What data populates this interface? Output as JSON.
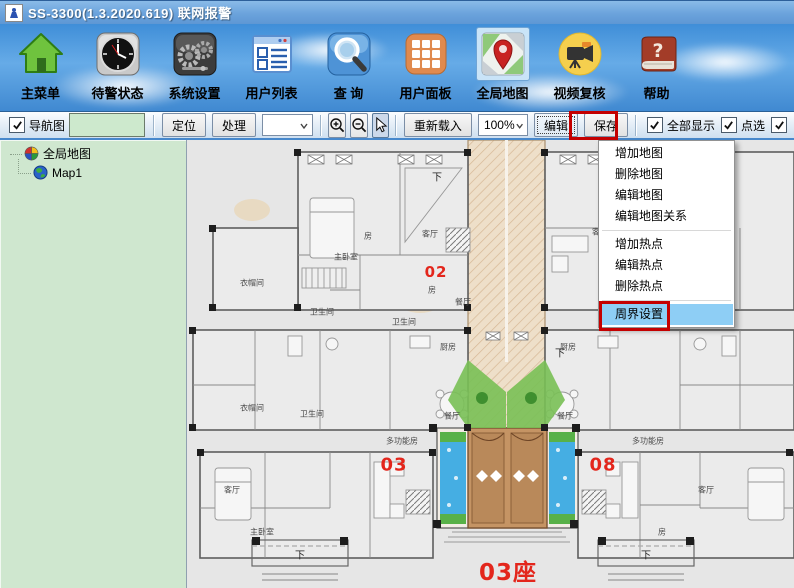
{
  "title_bar": {
    "title": "SS-3300(1.3.2020.619)  联网报警"
  },
  "main_toolbar": {
    "items": [
      {
        "label": "主菜单",
        "icon": "home-icon"
      },
      {
        "label": "待警状态",
        "icon": "clock-icon"
      },
      {
        "label": "系统设置",
        "icon": "gears-icon"
      },
      {
        "label": "用户列表",
        "icon": "user-list-icon"
      },
      {
        "label": "查  询",
        "icon": "search-icon"
      },
      {
        "label": "用户面板",
        "icon": "grid-icon"
      },
      {
        "label": "全局地图",
        "icon": "map-icon",
        "selected": true
      },
      {
        "label": "视频复核",
        "icon": "video-icon"
      },
      {
        "label": "帮助",
        "icon": "help-icon"
      }
    ]
  },
  "toolbar2": {
    "nav_label": "导航图",
    "nav_value": "",
    "locate_label": "定位",
    "process_label": "处理",
    "combo_value": "",
    "reload_label": "重新载入",
    "zoom_value": "100%",
    "edit_label": "编辑",
    "save_label": "保存",
    "show_all_label": "全部显示",
    "pick_label": "点选"
  },
  "tree": {
    "root_label": "全局地图",
    "child_label": "Map1"
  },
  "context_menu": {
    "items": [
      {
        "label": "增加地图"
      },
      {
        "label": "删除地图"
      },
      {
        "label": "编辑地图"
      },
      {
        "label": "编辑地图关系"
      },
      {
        "label": "增加热点"
      },
      {
        "label": "编辑热点"
      },
      {
        "label": "删除热点"
      },
      {
        "label": "周界设置",
        "highlighted": true
      }
    ]
  },
  "map": {
    "steps": [
      {
        "text": "第一步",
        "x": 545,
        "y": 150,
        "s": 21
      },
      {
        "text": "第二步",
        "x": 556,
        "y": 316,
        "s": 21
      }
    ],
    "unit_labels": [
      {
        "text": "02",
        "x": 436,
        "y": 272,
        "s": 15
      },
      {
        "text": "03",
        "x": 394,
        "y": 465,
        "s": 18
      },
      {
        "text": "08",
        "x": 603,
        "y": 465,
        "s": 18
      },
      {
        "text": "03座",
        "x": 508,
        "y": 570,
        "s": 23
      }
    ],
    "room_labels": [
      {
        "text": "主卧室",
        "x": 346,
        "y": 257
      },
      {
        "text": "房",
        "x": 368,
        "y": 236
      },
      {
        "text": "客厅",
        "x": 430,
        "y": 234
      },
      {
        "text": "衣帽间",
        "x": 252,
        "y": 283
      },
      {
        "text": "卫生间",
        "x": 322,
        "y": 312
      },
      {
        "text": "房",
        "x": 432,
        "y": 290
      },
      {
        "text": "卫生间",
        "x": 404,
        "y": 322
      },
      {
        "text": "餐厅",
        "x": 463,
        "y": 302
      },
      {
        "text": "厨房",
        "x": 448,
        "y": 347
      },
      {
        "text": "客厅",
        "x": 600,
        "y": 232
      },
      {
        "text": "餐厅",
        "x": 652,
        "y": 300
      },
      {
        "text": "厨房",
        "x": 568,
        "y": 347
      },
      {
        "text": "餐厅",
        "x": 452,
        "y": 416
      },
      {
        "text": "餐厅",
        "x": 565,
        "y": 416
      },
      {
        "text": "多功能房",
        "x": 402,
        "y": 441
      },
      {
        "text": "多功能房",
        "x": 648,
        "y": 441
      },
      {
        "text": "卫生间",
        "x": 312,
        "y": 414
      },
      {
        "text": "衣帽间",
        "x": 252,
        "y": 408
      },
      {
        "text": "客厅",
        "x": 232,
        "y": 490
      },
      {
        "text": "主卧室",
        "x": 262,
        "y": 532
      },
      {
        "text": "客厅",
        "x": 706,
        "y": 490
      },
      {
        "text": "房",
        "x": 662,
        "y": 532
      }
    ],
    "stair_labels": [
      {
        "text": "下",
        "x": 437,
        "y": 176
      },
      {
        "text": "下",
        "x": 712,
        "y": 168
      },
      {
        "text": "下",
        "x": 560,
        "y": 352
      },
      {
        "text": "下",
        "x": 300,
        "y": 554
      },
      {
        "text": "下",
        "x": 646,
        "y": 554
      }
    ],
    "watermark": "SouFun"
  },
  "icons": {
    "help_glyph": "?"
  },
  "colors": {
    "annotation_red": "#e3261c",
    "box_red": "#c40000",
    "menu_highlight_blue": "#8ecef5",
    "toolbar_sky_blue": "#4f9bdf",
    "tree_green": "#cfe7cf",
    "nav_field_green": "#cde9cd",
    "map_bg": "#e6e6e6"
  }
}
